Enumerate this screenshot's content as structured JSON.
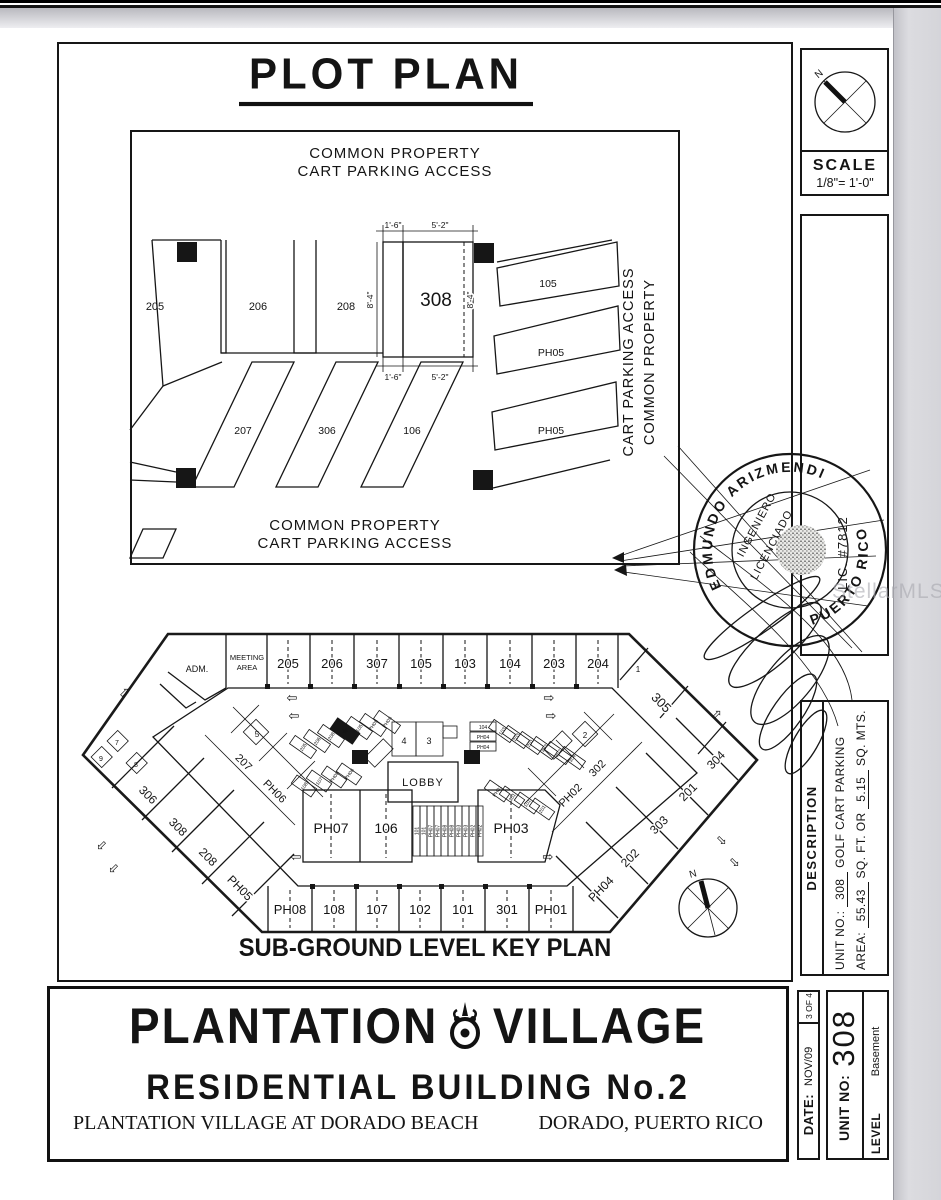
{
  "watermark": "StellarMLS",
  "plot_plan": {
    "title": "PLOT PLAN",
    "note_top_line1": "COMMON PROPERTY",
    "note_top_line2": "CART PARKING ACCESS",
    "note_bottom_line1": "COMMON PROPERTY",
    "note_bottom_line2": "CART PARKING ACCESS",
    "note_side_line1": "CART PARKING ACCESS",
    "note_side_line2": "COMMON PROPERTY",
    "stall_205": "205",
    "stall_206": "206",
    "stall_208": "208",
    "stall_308": "308",
    "stall_105": "105",
    "stall_ph05a": "PH05",
    "stall_ph05b": "PH05",
    "stall_207": "207",
    "stall_306": "306",
    "stall_106": "106",
    "dim_top_w1": "1'-6\"",
    "dim_top_w2": "5'-2\"",
    "dim_left_h": "8'-4\"",
    "dim_right_h": "8'-4\"",
    "dim_bot_w1": "1'-6\"",
    "dim_bot_w2": "5'-2\""
  },
  "scale_box": {
    "north": "N",
    "label": "SCALE",
    "value": "1/8\"= 1'-0\""
  },
  "stamp": {
    "arc_top": "EDMUNDO   ARIZMENDI",
    "arc_right": "PUERTO RICO",
    "inner1": "INGENIERO",
    "inner2": "LICENCIADO",
    "lic": "LIC. #7812"
  },
  "key_plan": {
    "caption": "SUB-GROUND LEVEL KEY PLAN",
    "adm": "ADM.",
    "meeting1": "MEETING",
    "meeting2": "AREA",
    "top_row": [
      "205",
      "206",
      "307",
      "105",
      "103",
      "104",
      "203",
      "204"
    ],
    "corner1": "1",
    "u305": "305",
    "right_outer": [
      "304",
      "201",
      "303",
      "202",
      "PH04"
    ],
    "right_inner": [
      "302",
      "PH02"
    ],
    "left_outer": [
      "306",
      "308",
      "208",
      "PH05"
    ],
    "left_inner": [
      "207",
      "PH06"
    ],
    "bottom_row": [
      "PH08",
      "108",
      "107",
      "102",
      "101",
      "301",
      "PH01"
    ],
    "inner_units": [
      "PH07",
      "106",
      "PH03"
    ],
    "lobby": "LOBBY",
    "room3": "3",
    "room4": "4",
    "room5": "5",
    "room2": "2",
    "room7": "7",
    "room8": "8",
    "room9": "9",
    "center_slots": [
      "101",
      "101",
      "PH07",
      "PH07",
      "PH08",
      "PH08",
      "PH03",
      "PH03",
      "PH02",
      "PH02"
    ],
    "left_cluster": [
      "205",
      "206",
      "208",
      "105",
      "PH05",
      "PH05"
    ],
    "left_cluster2": [
      "108",
      "107",
      "PH08",
      "PH06"
    ],
    "right_cluster": [
      "104",
      "PH04",
      "PH04"
    ],
    "right_cluster2": [
      "103",
      "203",
      "201",
      "303",
      "302",
      "304"
    ],
    "right_cluster3": [
      "PH01",
      "301",
      "101",
      "201"
    ],
    "star": "★",
    "north": "N"
  },
  "description": {
    "label": "DESCRIPTION",
    "unit_label": "UNIT NO.:",
    "unit_value": "308",
    "unit_use": "GOLF CART PARKING",
    "area_label": "AREA:",
    "area_sqft": "55.43",
    "area_mid": "SQ. FT.  OR",
    "area_sqm": "5.15",
    "area_unit": "SQ. MTS."
  },
  "title_block": {
    "line1_left": "PLANTATION",
    "line1_right": "VILLAGE",
    "line2": "RESIDENTIAL BUILDING No.2",
    "line3_left": "PLANTATION VILLAGE AT DORADO BEACH",
    "line3_right": "DORADO, PUERTO RICO"
  },
  "date_block": {
    "label": "DATE:",
    "value": "NOV/09",
    "sheet": "3  OF  4"
  },
  "unit_block": {
    "label": "UNIT NO:",
    "value": "308",
    "level_label": "LEVEL",
    "level_value": "Basement"
  }
}
